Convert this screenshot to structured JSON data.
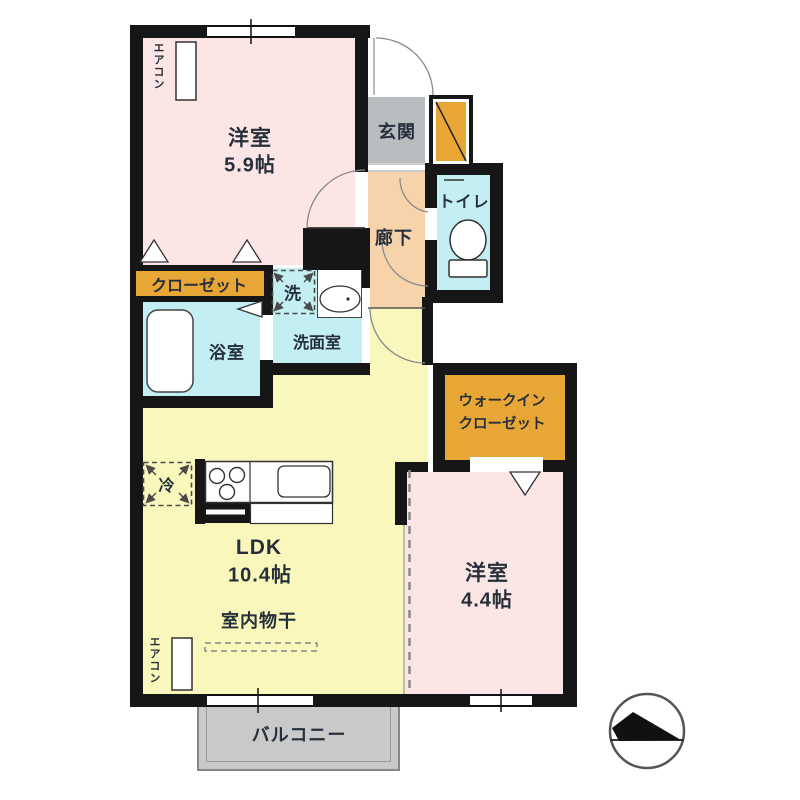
{
  "floor_plan": {
    "rooms": {
      "bedroom1": {
        "label": "洋室",
        "size": "5.9帖"
      },
      "bedroom2": {
        "label": "洋室",
        "size": "4.4帖"
      },
      "ldk": {
        "label": "LDK",
        "size": "10.4帖"
      },
      "entrance": {
        "label": "玄関"
      },
      "hallway": {
        "label": "廊下"
      },
      "toilet": {
        "label": "トイレ"
      },
      "closet": {
        "label": "クローゼット"
      },
      "washer": {
        "label": "洗"
      },
      "washroom": {
        "label": "洗面室"
      },
      "bathroom": {
        "label": "浴室"
      },
      "walk_in_closet": {
        "label_line1": "ウォークイン",
        "label_line2": "クローゼット"
      },
      "balcony": {
        "label": "バルコニー"
      },
      "refrigerator": {
        "label": "冷"
      },
      "indoor_drying": {
        "label": "室内物干"
      },
      "aircon": {
        "label": "エアコン"
      }
    },
    "colors": {
      "wall": "#161616",
      "room_pink": "#fbe5e5",
      "ldk_yellow": "#f9f7bb",
      "wet_area_cyan": "#c3eef2",
      "hallway_salmon": "#f6d3ab",
      "entrance_gray": "#b9bdc0",
      "storage_orange": "#e7a636",
      "balcony_gray": "#c9c9c9"
    }
  }
}
